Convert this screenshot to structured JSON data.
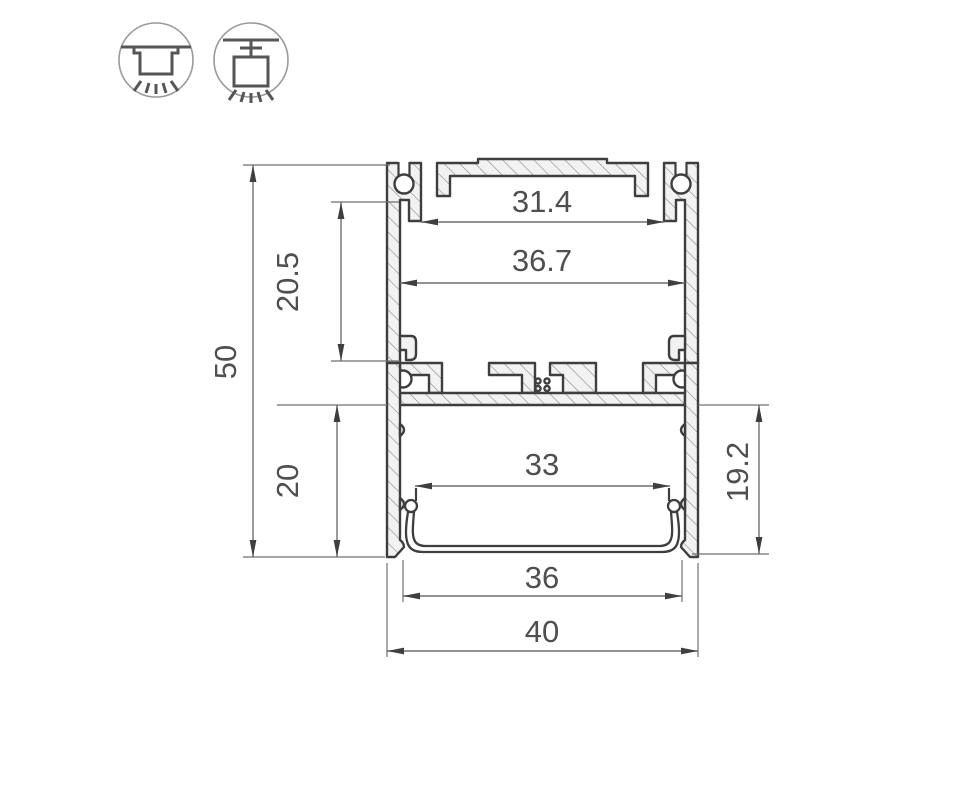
{
  "drawing": {
    "type": "led-profile-cross-section",
    "mount_icons": [
      {
        "name": "surface-mount-icon",
        "meaning": "surface ceiling mount luminaire"
      },
      {
        "name": "pendant-mount-icon",
        "meaning": "suspended pendant luminaire"
      }
    ],
    "dimensions": {
      "top_slot_width": "31.4",
      "inner_width_top": "36.7",
      "upper_chamber_height": "20.5",
      "overall_height": "50",
      "diffuser_width": "33",
      "lower_chamber_height": "20",
      "inner_height_lower": "19.2",
      "inner_width_bottom": "36",
      "overall_width": "40"
    },
    "colors": {
      "outline": "#3e3e3e",
      "dimension_lines": "#6f6f6f",
      "dimension_text": "#4f4f4f",
      "hatch": "#8a8a8a",
      "aluminum_fill": "#f2f2f2",
      "background": "#ffffff"
    }
  }
}
